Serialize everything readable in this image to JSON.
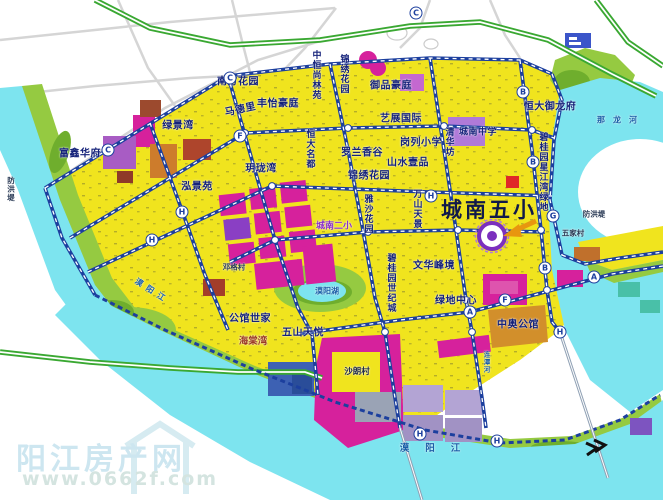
{
  "watermark": {
    "site_name": "阳江房产网",
    "url": "www.0662f.com"
  },
  "map": {
    "featured_school": "城南五小",
    "colors": {
      "land_yellow": "#f0e41e",
      "water_cyan": "#7de4ef",
      "park_green": "#95ca41",
      "road_blue": "#1c3f9e",
      "expressway_green": "#3aa832",
      "block_magenta": "#d6219c",
      "block_purple": "#a85cc4",
      "block_orange": "#cd7c2c",
      "school_icon_purple": "#7b2fbe",
      "watermark_blue": "#cfe7ef"
    },
    "labels": [
      {
        "name": "label-nanfang-huayuan",
        "text": "南方花园",
        "x": 238,
        "y": 80,
        "cls": "estate"
      },
      {
        "name": "label-zhongheng-shanglinyuan",
        "text": "中恒尚林苑",
        "x": 316,
        "y": 75,
        "cls": "estate v sz9"
      },
      {
        "name": "label-jinxiu-huayuan-north",
        "text": "锦绣花园",
        "x": 344,
        "y": 74,
        "cls": "estate v sz9"
      },
      {
        "name": "label-yupin-haoting",
        "text": "御品豪庭",
        "x": 391,
        "y": 84,
        "cls": "estate"
      },
      {
        "name": "label-fengyi-haoting",
        "text": "丰怡豪庭",
        "x": 278,
        "y": 102,
        "cls": "estate"
      },
      {
        "name": "label-madeli",
        "text": "马德里",
        "x": 240,
        "y": 108,
        "cls": "estate",
        "rot": -12
      },
      {
        "name": "label-lvjingwan",
        "text": "绿景湾",
        "x": 178,
        "y": 124,
        "cls": "estate"
      },
      {
        "name": "label-fuxin-huafu",
        "text": "富鑫华府",
        "x": 80,
        "y": 152,
        "cls": "estate"
      },
      {
        "name": "label-hongjingyuan",
        "text": "泓景苑",
        "x": 197,
        "y": 185,
        "cls": "estate"
      },
      {
        "name": "label-yuelongwan",
        "text": "玥珑湾",
        "x": 261,
        "y": 167,
        "cls": "estate"
      },
      {
        "name": "label-hengda-mingdu",
        "text": "恒大名都",
        "x": 310,
        "y": 149,
        "cls": "estate v sz9"
      },
      {
        "name": "label-luolan-xianggu",
        "text": "罗兰香谷",
        "x": 362,
        "y": 151,
        "cls": "estate"
      },
      {
        "name": "label-shanshui-yipin",
        "text": "山水壹品",
        "x": 408,
        "y": 161,
        "cls": "estate"
      },
      {
        "name": "label-jinxiu-huayuan-south",
        "text": "锦绣花园",
        "x": 369,
        "y": 174,
        "cls": "estate"
      },
      {
        "name": "label-yizhan-guoji",
        "text": "艺展国际",
        "x": 401,
        "y": 117,
        "cls": "estate"
      },
      {
        "name": "label-ganglie-xiaoxue",
        "text": "岗列小学",
        "x": 421,
        "y": 141,
        "cls": "estate"
      },
      {
        "name": "label-qinghuafang",
        "text": "清华坊",
        "x": 449,
        "y": 142,
        "cls": "estate v sz9"
      },
      {
        "name": "label-chengnan-zhongxue",
        "text": "城南中学",
        "x": 478,
        "y": 131,
        "cls": "estate sz9"
      },
      {
        "name": "label-hengda-yulongfu",
        "text": "恒大御龙府",
        "x": 550,
        "y": 105,
        "cls": "estate"
      },
      {
        "name": "label-biguiyuan-xingjiangwan-lvdi",
        "text": "碧桂园星江湾绿地",
        "x": 543,
        "y": 172,
        "cls": "estate v sz9"
      },
      {
        "name": "label-chengnan-wuxiao",
        "text": "城南五小",
        "x": 489,
        "y": 209,
        "cls": "school"
      },
      {
        "name": "label-wenhua-fengjing",
        "text": "文华峰境",
        "x": 434,
        "y": 264,
        "cls": "estate"
      },
      {
        "name": "label-biguiyuan-shijicheng",
        "text": "碧桂园世纪城",
        "x": 391,
        "y": 283,
        "cls": "estate v sz9"
      },
      {
        "name": "label-lvdi-zhongxin",
        "text": "绿地中心",
        "x": 456,
        "y": 299,
        "cls": "estate"
      },
      {
        "name": "label-zhongao-gongguan",
        "text": "中奥公馆",
        "x": 518,
        "y": 323,
        "cls": "estate"
      },
      {
        "name": "label-gongguan-shijia",
        "text": "公馆世家",
        "x": 250,
        "y": 317,
        "cls": "estate"
      },
      {
        "name": "label-haitangwan",
        "text": "海棠湾",
        "x": 253,
        "y": 340,
        "cls": "red-sm"
      },
      {
        "name": "label-wushan-tianyue",
        "text": "五山天悦",
        "x": 303,
        "y": 331,
        "cls": "estate"
      },
      {
        "name": "label-chengnan-erxiao",
        "text": "城南二小",
        "x": 334,
        "y": 225,
        "cls": "purple-sm"
      },
      {
        "name": "label-wanshan-tianjing",
        "text": "万山天景",
        "x": 417,
        "y": 209,
        "cls": "estate v sz9"
      },
      {
        "name": "label-yasha-huayuan",
        "text": "雅沙花园",
        "x": 368,
        "y": 214,
        "cls": "estate v sz9"
      },
      {
        "name": "label-shalangcun",
        "text": "沙朗村",
        "x": 357,
        "y": 371,
        "cls": "village-strong"
      },
      {
        "name": "label-wujiacun",
        "text": "五家村",
        "x": 573,
        "y": 233,
        "cls": "village"
      },
      {
        "name": "label-denggecun",
        "text": "邓格村",
        "x": 234,
        "y": 267,
        "cls": "village"
      },
      {
        "name": "label-fanghongdi-left",
        "text": "防洪堤",
        "x": 11,
        "y": 189,
        "cls": "village v"
      },
      {
        "name": "label-fanghongdi-right",
        "text": "防洪堤",
        "x": 594,
        "y": 214,
        "cls": "village"
      },
      {
        "name": "label-moyangjiang",
        "text": "漠阳江",
        "x": 438,
        "y": 447,
        "cls": "water ls16"
      },
      {
        "name": "label-moyangjiang-left",
        "text": "漠阳江",
        "x": 152,
        "y": 291,
        "cls": "water-sm ls5",
        "rot": 33
      },
      {
        "name": "label-nalonghe",
        "text": "那龙河",
        "x": 621,
        "y": 120,
        "cls": "water-sm ls8"
      },
      {
        "name": "label-liantanhe",
        "text": "连潭河",
        "x": 486,
        "y": 362,
        "cls": "water-sm v tiny"
      },
      {
        "name": "label-moyanghu",
        "text": "漠阳湖",
        "x": 327,
        "y": 291,
        "cls": "water-sm"
      }
    ],
    "road_badges": [
      {
        "letter": "C",
        "x": 108,
        "y": 150
      },
      {
        "letter": "C",
        "x": 230,
        "y": 78
      },
      {
        "letter": "C",
        "x": 416,
        "y": 13
      },
      {
        "letter": "F",
        "x": 240,
        "y": 136
      },
      {
        "letter": "F",
        "x": 505,
        "y": 300
      },
      {
        "letter": "H",
        "x": 182,
        "y": 212
      },
      {
        "letter": "H",
        "x": 152,
        "y": 240
      },
      {
        "letter": "H",
        "x": 431,
        "y": 196
      },
      {
        "letter": "H",
        "x": 420,
        "y": 434
      },
      {
        "letter": "H",
        "x": 497,
        "y": 441
      },
      {
        "letter": "H",
        "x": 560,
        "y": 332
      },
      {
        "letter": "B",
        "x": 523,
        "y": 92
      },
      {
        "letter": "B",
        "x": 533,
        "y": 162
      },
      {
        "letter": "B",
        "x": 545,
        "y": 268
      },
      {
        "letter": "A",
        "x": 470,
        "y": 312
      },
      {
        "letter": "A",
        "x": 594,
        "y": 277
      },
      {
        "letter": "G",
        "x": 553,
        "y": 216
      }
    ]
  }
}
